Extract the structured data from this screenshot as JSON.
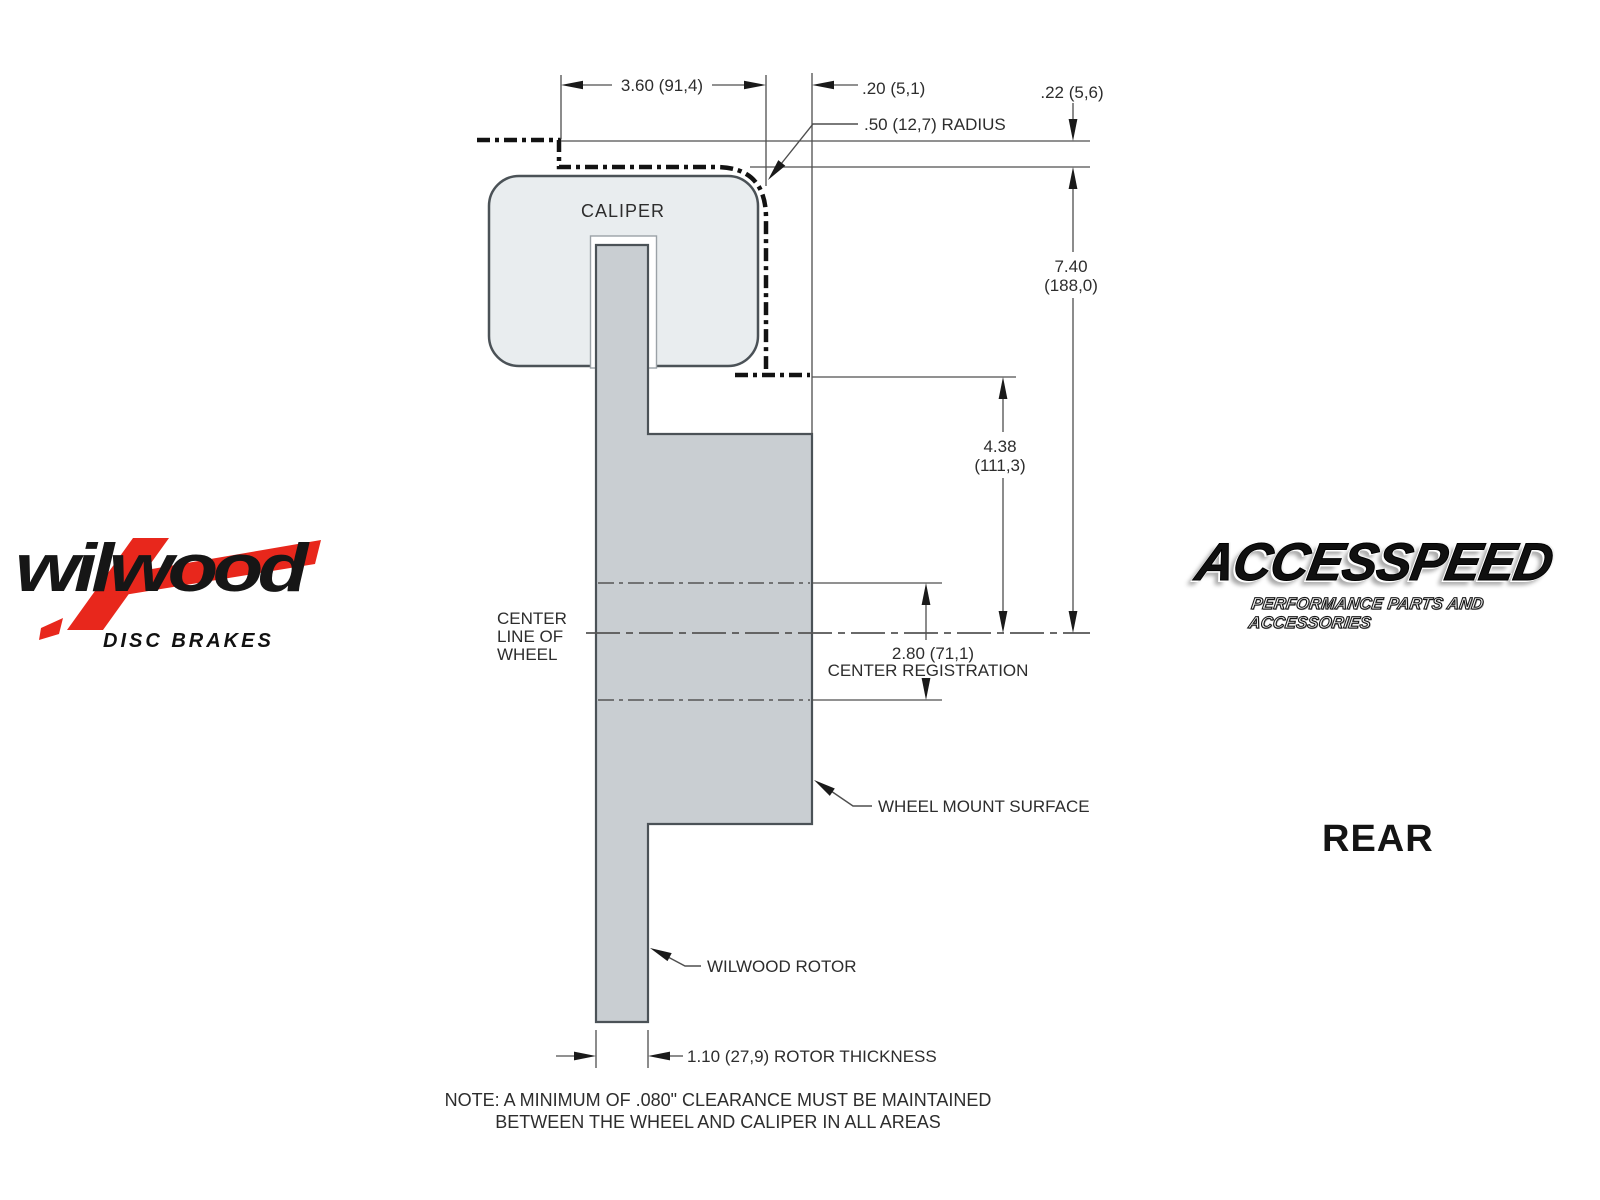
{
  "diagram": {
    "part_labels": {
      "caliper": "CALIPER"
    },
    "dim_width": "3.60 (91,4)",
    "dim_offset": ".20 (5,1)",
    "dim_clearance": ".22 (5,6)",
    "dim_radius": ".50 (12,7) RADIUS",
    "dim_radial_height": "7.40",
    "dim_radial_height_mm": "(188,0)",
    "dim_mount_depth": "4.38",
    "dim_mount_depth_mm": "(111,3)",
    "dim_center_reg": "2.80 (71,1)",
    "dim_center_reg_label": "CENTER REGISTRATION",
    "dim_rotor_thickness": "1.10 (27,9) ROTOR THICKNESS",
    "label_centerline_1": "CENTER",
    "label_centerline_2": "LINE OF",
    "label_centerline_3": "WHEEL",
    "label_wheel_mount": "WHEEL MOUNT SURFACE",
    "label_rotor": "WILWOOD ROTOR",
    "note_line1": "NOTE: A MINIMUM OF .080\" CLEARANCE MUST BE MAINTAINED",
    "note_line2": "BETWEEN THE WHEEL AND CALIPER IN ALL AREAS",
    "view": "REAR"
  },
  "branding": {
    "wilwood_name": "wilwood",
    "wilwood_tagline": "DISC BRAKES",
    "wilwood_red": "#e8271c",
    "accesspeed_name": "ACCESSPEED",
    "accesspeed_tagline": "PERFORMANCE PARTS AND ACCESSORIES"
  },
  "colors": {
    "caliper_fill": "#e9edef",
    "rotor_fill": "#c9ced2",
    "outline": "#4b5257",
    "dim_line": "#4f4f4f",
    "text": "#2d2d2d"
  }
}
